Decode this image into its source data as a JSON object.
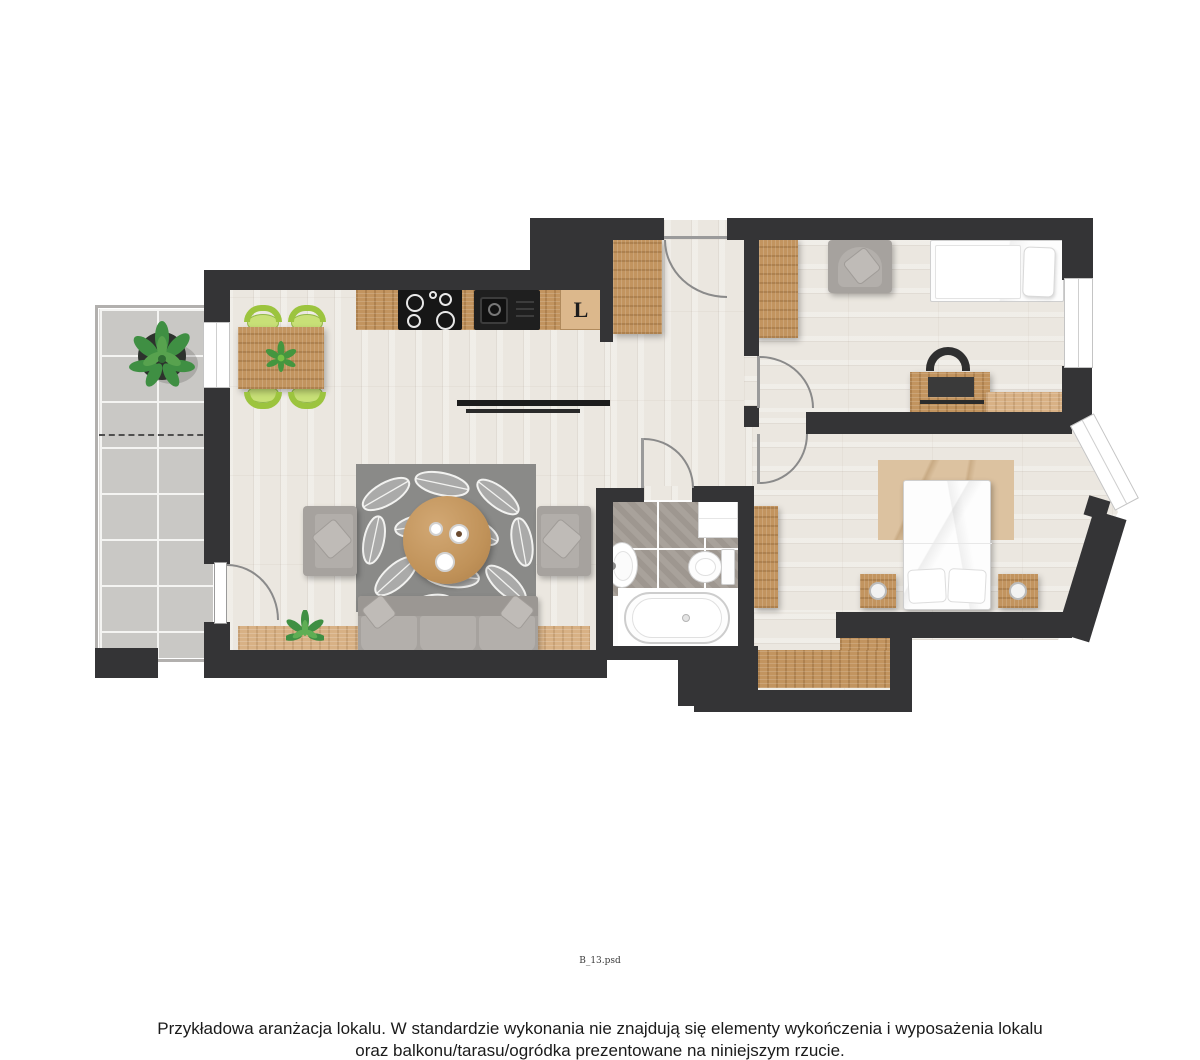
{
  "document": {
    "filename_label": "B_13.psd",
    "disclaimer": {
      "line1": "Przykładowa aranżacja lokalu. W standardzie wykonania nie znajdują się elementy wykończenia i wyposażenia lokalu",
      "line2": "oraz balkonu/tarasu/ogródka prezentowane na niniejszym rzucie."
    }
  },
  "plan": {
    "type": "apartment-floorplan",
    "appliance_labels": {
      "fridge": "L"
    },
    "rooms": [
      {
        "name": "balcony"
      },
      {
        "name": "living-room-with-kitchenette"
      },
      {
        "name": "hallway"
      },
      {
        "name": "bathroom"
      },
      {
        "name": "bedroom"
      },
      {
        "name": "study-bedroom"
      }
    ]
  },
  "colors": {
    "wall": "#343436",
    "floor_wood": "#ebe7e0",
    "oak": "#c2945f",
    "oak_light": "#d8b185",
    "balcony_tile": "#c9c8c5",
    "bath_tile": "#a49d96",
    "rug_gray": "#8e8e8c",
    "sofa_gray": "#a6a29e",
    "bedroom_rug": "#dcc2a0",
    "chair_green": "#9cc43e",
    "arc_color": "#8a8a8a",
    "bed_white": "#fdfdfd"
  }
}
